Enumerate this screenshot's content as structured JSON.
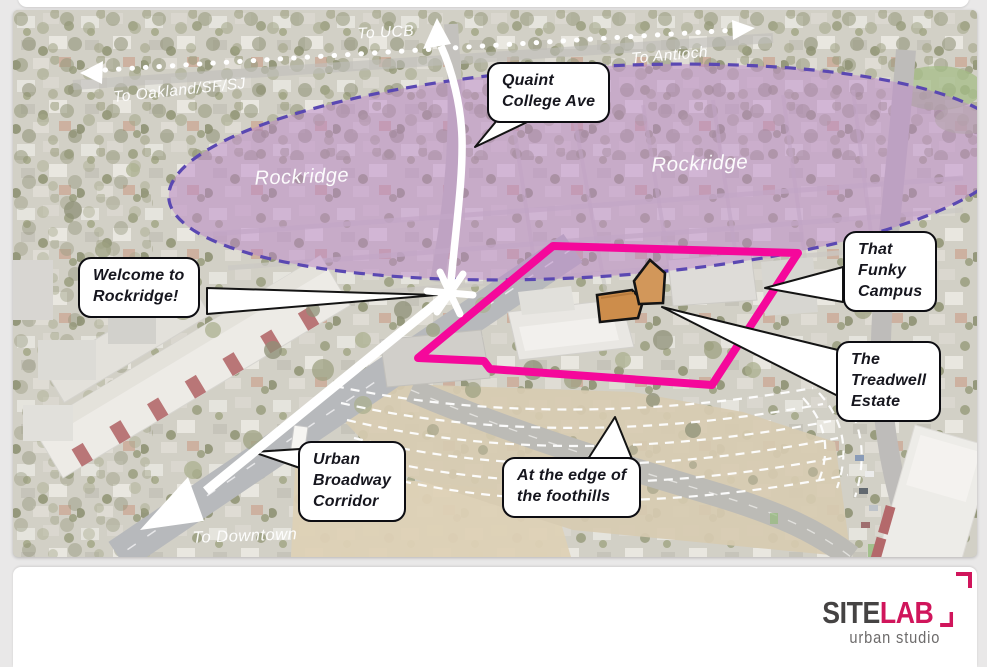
{
  "page": {
    "background": "#E9E8E8"
  },
  "map": {
    "region_labels": {
      "rockridge_left": "Rockridge",
      "rockridge_right": "Rockridge"
    },
    "direction_labels": {
      "to_ucb": "To UCB",
      "to_oakland": "To Oakland/SF/SJ",
      "to_antioch": "To Antioch",
      "to_downtown": "To Downtown"
    },
    "callouts": {
      "quaint": {
        "text": "Quaint\nCollege Ave"
      },
      "welcome": {
        "text": "Welcome to\nRockridge!"
      },
      "funky": {
        "text": "That\nFunky\nCampus"
      },
      "treadwell": {
        "text": "The\nTreadwell\nEstate"
      },
      "broadway": {
        "text": "Urban\nBroadway\nCorridor"
      },
      "foothills": {
        "text": "At the edge of\nthe foothills"
      }
    },
    "colors": {
      "site_boundary_pink": "#F5089B",
      "district_purple": "#5A48B2",
      "district_fill": "rgba(187,134,201,0.5)",
      "highlight_orange": "#D2975A",
      "arrow_white": "#FFFFFF"
    }
  },
  "footer": {
    "logo": {
      "site": "SITE",
      "lab": "LAB",
      "subtitle": "urban studio",
      "brand_color": "#D0155B"
    }
  }
}
